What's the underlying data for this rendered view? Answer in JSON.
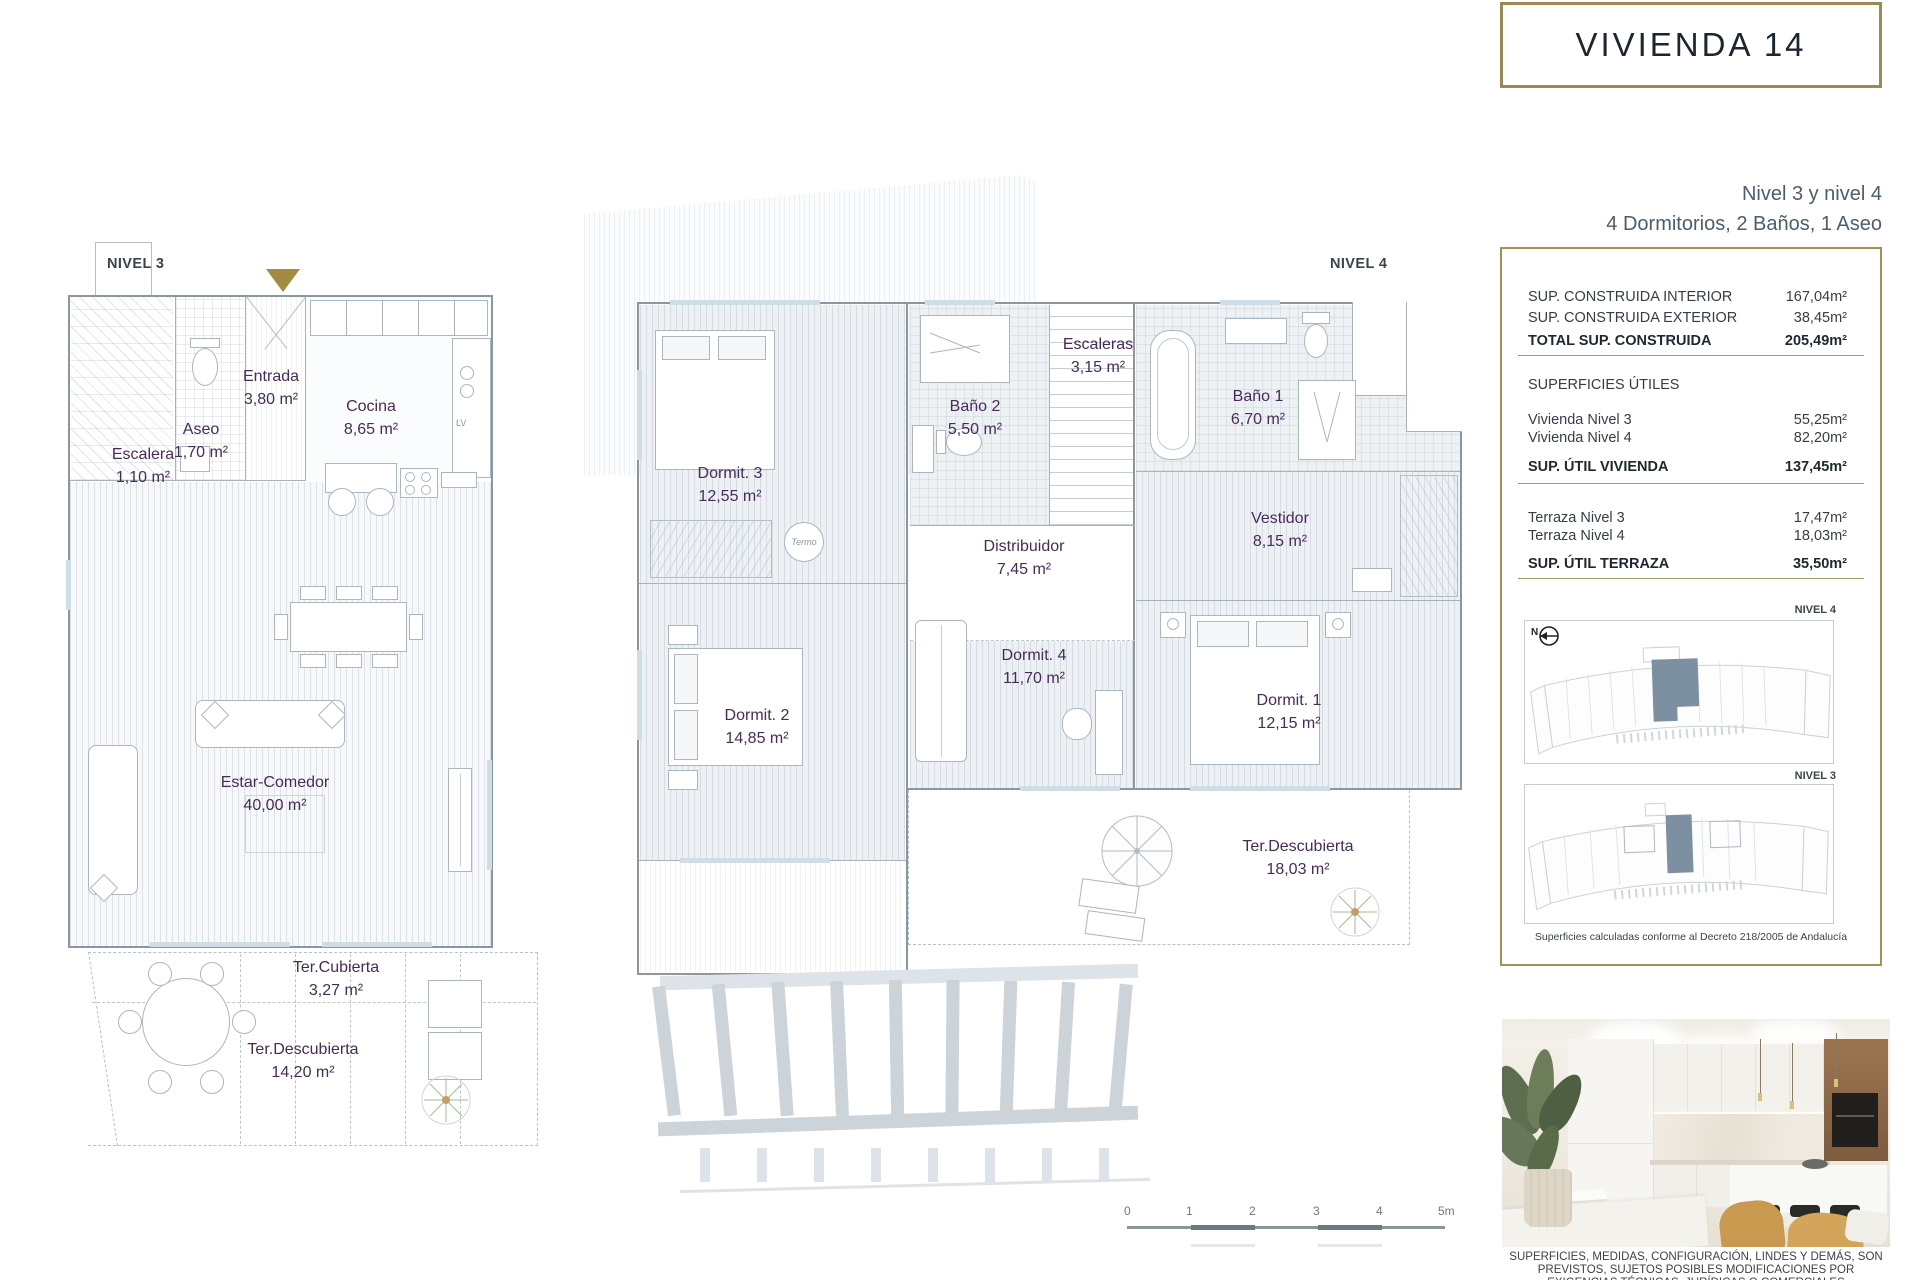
{
  "header": {
    "title": "VIVIENDA 14",
    "subtitle_line1": "Nivel 3 y nivel 4",
    "subtitle_line2": "4 Dormitorios, 2 Baños, 1 Aseo"
  },
  "summary": {
    "construida": [
      {
        "label": "SUP. CONSTRUIDA INTERIOR",
        "value": "167,04m²"
      },
      {
        "label": "SUP. CONSTRUIDA EXTERIOR",
        "value": "38,45m²"
      },
      {
        "label": "TOTAL SUP. CONSTRUIDA",
        "value": "205,49m²"
      }
    ],
    "utiles_heading": "SUPERFICIES ÚTILES",
    "utiles": [
      {
        "label": "Vivienda Nivel 3",
        "value": "55,25m²"
      },
      {
        "label": "Vivienda Nivel 4",
        "value": "82,20m²"
      },
      {
        "label": "SUP. ÚTIL VIVIENDA",
        "value": "137,45m²"
      }
    ],
    "terraza": [
      {
        "label": "Terraza Nivel 3",
        "value": "17,47m²"
      },
      {
        "label": "Terraza Nivel 4",
        "value": "18,03m²"
      },
      {
        "label": "SUP. ÚTIL TERRAZA",
        "value": "35,50m²"
      }
    ],
    "mini_nivel4_label": "NIVEL 4",
    "mini_nivel3_label": "NIVEL 3",
    "compass_label": "N",
    "note": "Superficies calculadas conforme al Decreto 218/2005 de Andalucía"
  },
  "nivel3": {
    "label": "NIVEL 3",
    "kitchen_lv_label": "LV",
    "rooms": {
      "entrada": {
        "name": "Entrada",
        "area": "3,80 m²"
      },
      "cocina": {
        "name": "Cocina",
        "area": "8,65 m²"
      },
      "aseo": {
        "name": "Aseo",
        "area": "1,70 m²"
      },
      "escalera": {
        "name": "Escalera",
        "area": "1,10 m²"
      },
      "estar": {
        "name": "Estar-Comedor",
        "area": "40,00 m²"
      },
      "tercubierta": {
        "name": "Ter.Cubierta",
        "area": "3,27 m²"
      },
      "terdescubierta": {
        "name": "Ter.Descubierta",
        "area": "14,20 m²"
      }
    }
  },
  "nivel4": {
    "label": "NIVEL 4",
    "termo_label": "Termo",
    "rooms": {
      "escaleras": {
        "name": "Escaleras",
        "area": "3,15 m²"
      },
      "bano2": {
        "name": "Baño 2",
        "area": "5,50 m²"
      },
      "bano1": {
        "name": "Baño 1",
        "area": "6,70 m²"
      },
      "dormit3": {
        "name": "Dormit. 3",
        "area": "12,55 m²"
      },
      "distribuidor": {
        "name": "Distribuidor",
        "area": "7,45 m²"
      },
      "vestidor": {
        "name": "Vestidor",
        "area": "8,15 m²"
      },
      "dormit2": {
        "name": "Dormit. 2",
        "area": "14,85 m²"
      },
      "dormit4": {
        "name": "Dormit. 4",
        "area": "11,70 m²"
      },
      "dormit1": {
        "name": "Dormit. 1",
        "area": "12,15 m²"
      },
      "terdescubierta": {
        "name": "Ter.Descubierta",
        "area": "18,03 m²"
      }
    }
  },
  "scalebar": {
    "ticks": [
      "0",
      "1",
      "2",
      "3",
      "4",
      "5m"
    ]
  },
  "disclaimer": {
    "line1": "SUPERFICIES, MEDIDAS, CONFIGURACIÓN, LINDES Y DEMÁS, SON",
    "line2": "PREVISTOS, SUJETOS POSIBLES MODIFICACIONES POR",
    "line3": "EXIGENCIAS TÉCNICAS, JURÍDICAS O COMERCIALES"
  },
  "colors": {
    "gold": "#9c8a52",
    "room_label_purple": "#472b59",
    "wall_gray": "#8a96a2",
    "highlight_unit": "#7c90a2"
  }
}
